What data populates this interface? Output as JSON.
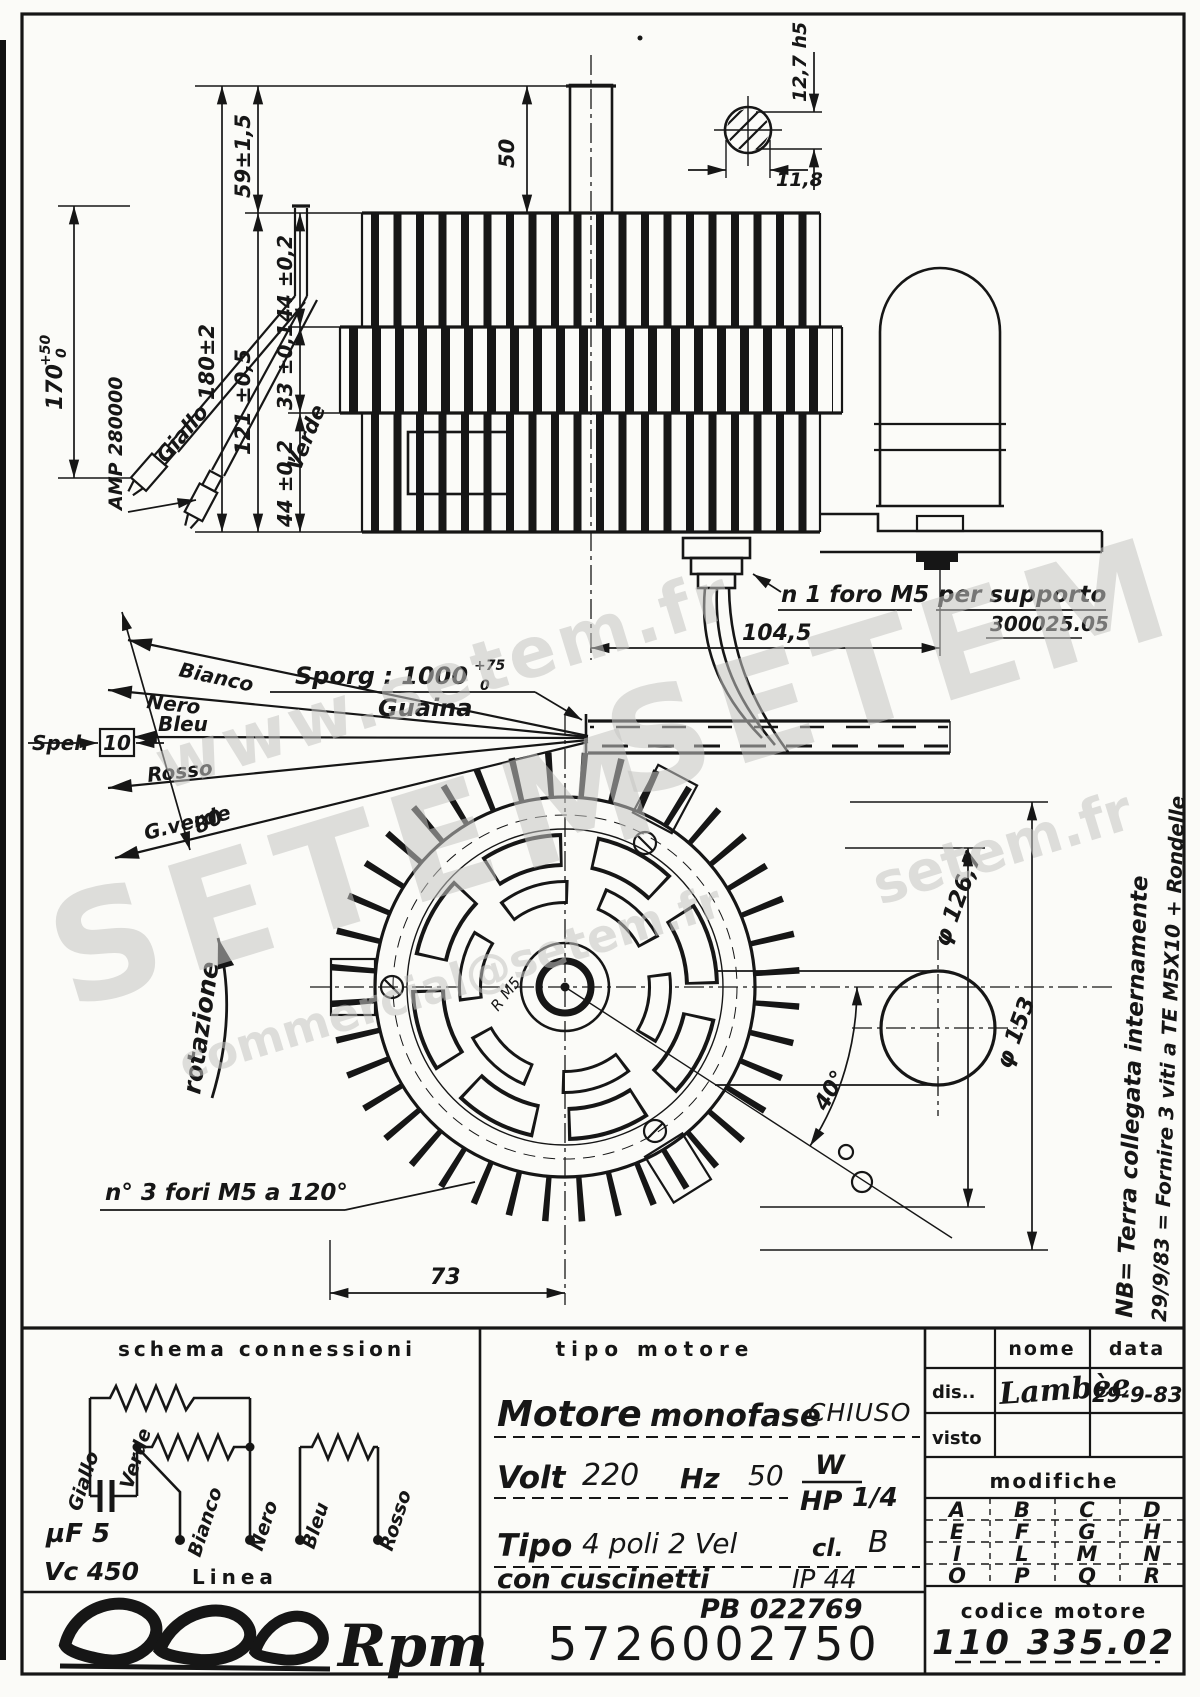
{
  "sheet": {
    "watermarks": {
      "url": "www.setem.fr",
      "brand_a": "SETEM",
      "brand_b": "SETEM",
      "email": "commercial@setem.fr",
      "url_short": "setem.fr"
    }
  },
  "side_view": {
    "dim_total": "180±2",
    "dim_59": "59±1,5",
    "dim_121": "121 ±0,5",
    "dim_44_top": "44 ±0,2",
    "dim_33": "33 ±0,1",
    "dim_44_bot": "44 ±0,2",
    "dim_shaft": "50",
    "key_height": "12,7 h5",
    "key_width": "11,8",
    "cable_len": "170",
    "cable_tol_up": "+50",
    "cable_tol_dn": "0",
    "wire_yellow": "Giallo",
    "wire_green": "Verde",
    "terminal": "AMP 280000",
    "hole_note": "n 1 foro M5",
    "support_note": "per supporto",
    "support_code": "300025.05",
    "dim_support": "104,5"
  },
  "leads": {
    "protrusion": "Sporg : 1000",
    "protrusion_tol_up": "+75",
    "protrusion_tol_dn": "0",
    "sheath": "Guaina",
    "strip": "Spel.",
    "strip_len": "10",
    "dim_fan": "80",
    "wires": [
      "Bianco",
      "Nero",
      "Bleu",
      "Rosso",
      "G.verde"
    ]
  },
  "front_view": {
    "rotation": "rotazione",
    "holes_note": "n° 3 fori M5 a 120°",
    "dia_inner": "φ 126,7",
    "dia_outer": "φ 153",
    "angle": "40°",
    "dim_shaft_offset": "73",
    "radius_note": "R M5"
  },
  "margin_notes": {
    "earth": "NB= Terra collegata internamente",
    "revision": "29/9/83 = Fornire 3 viti a TE M5X10 + Rondelle"
  },
  "schema": {
    "header": "schema connessioni",
    "giallo": "Giallo",
    "verde": "Verde",
    "bianco": "Bianco",
    "nero": "Nero",
    "bleu": "Bleu",
    "rosso": "Rosso",
    "capacitance": "µF 5",
    "voltage": "Vc 450",
    "line": "Linea"
  },
  "motor_info": {
    "header": "tipo motore",
    "motore": "Motore",
    "monofase": "monofase",
    "chiuso": "CHIUSO",
    "volt_label": "Volt",
    "volt": "220",
    "hz_label": "Hz",
    "hz": "50",
    "w_label": "W",
    "hp_label": "HP",
    "hp": "1/4",
    "tipo_label": "Tipo",
    "tipo": "4 poli  2 Vel",
    "cl_label": "cl.",
    "cl": "B",
    "bearings": "con  cuscinetti",
    "ip": "IP 44",
    "pb_code": "PB 022769",
    "part_number": "5726002750"
  },
  "revision_block": {
    "nome": "nome",
    "data": "data",
    "dis": "dis..",
    "signature": "Lambèe",
    "date": "29-9-83",
    "visto": "visto",
    "modifiche": "modifiche",
    "letters": [
      "A",
      "B",
      "C",
      "D",
      "E",
      "F",
      "G",
      "H",
      "I",
      "L",
      "M",
      "N",
      "O",
      "P",
      "Q",
      "R"
    ],
    "codice_label": "codice motore",
    "codice": "110 335.02"
  },
  "logo": {
    "brand": "Rpm"
  }
}
